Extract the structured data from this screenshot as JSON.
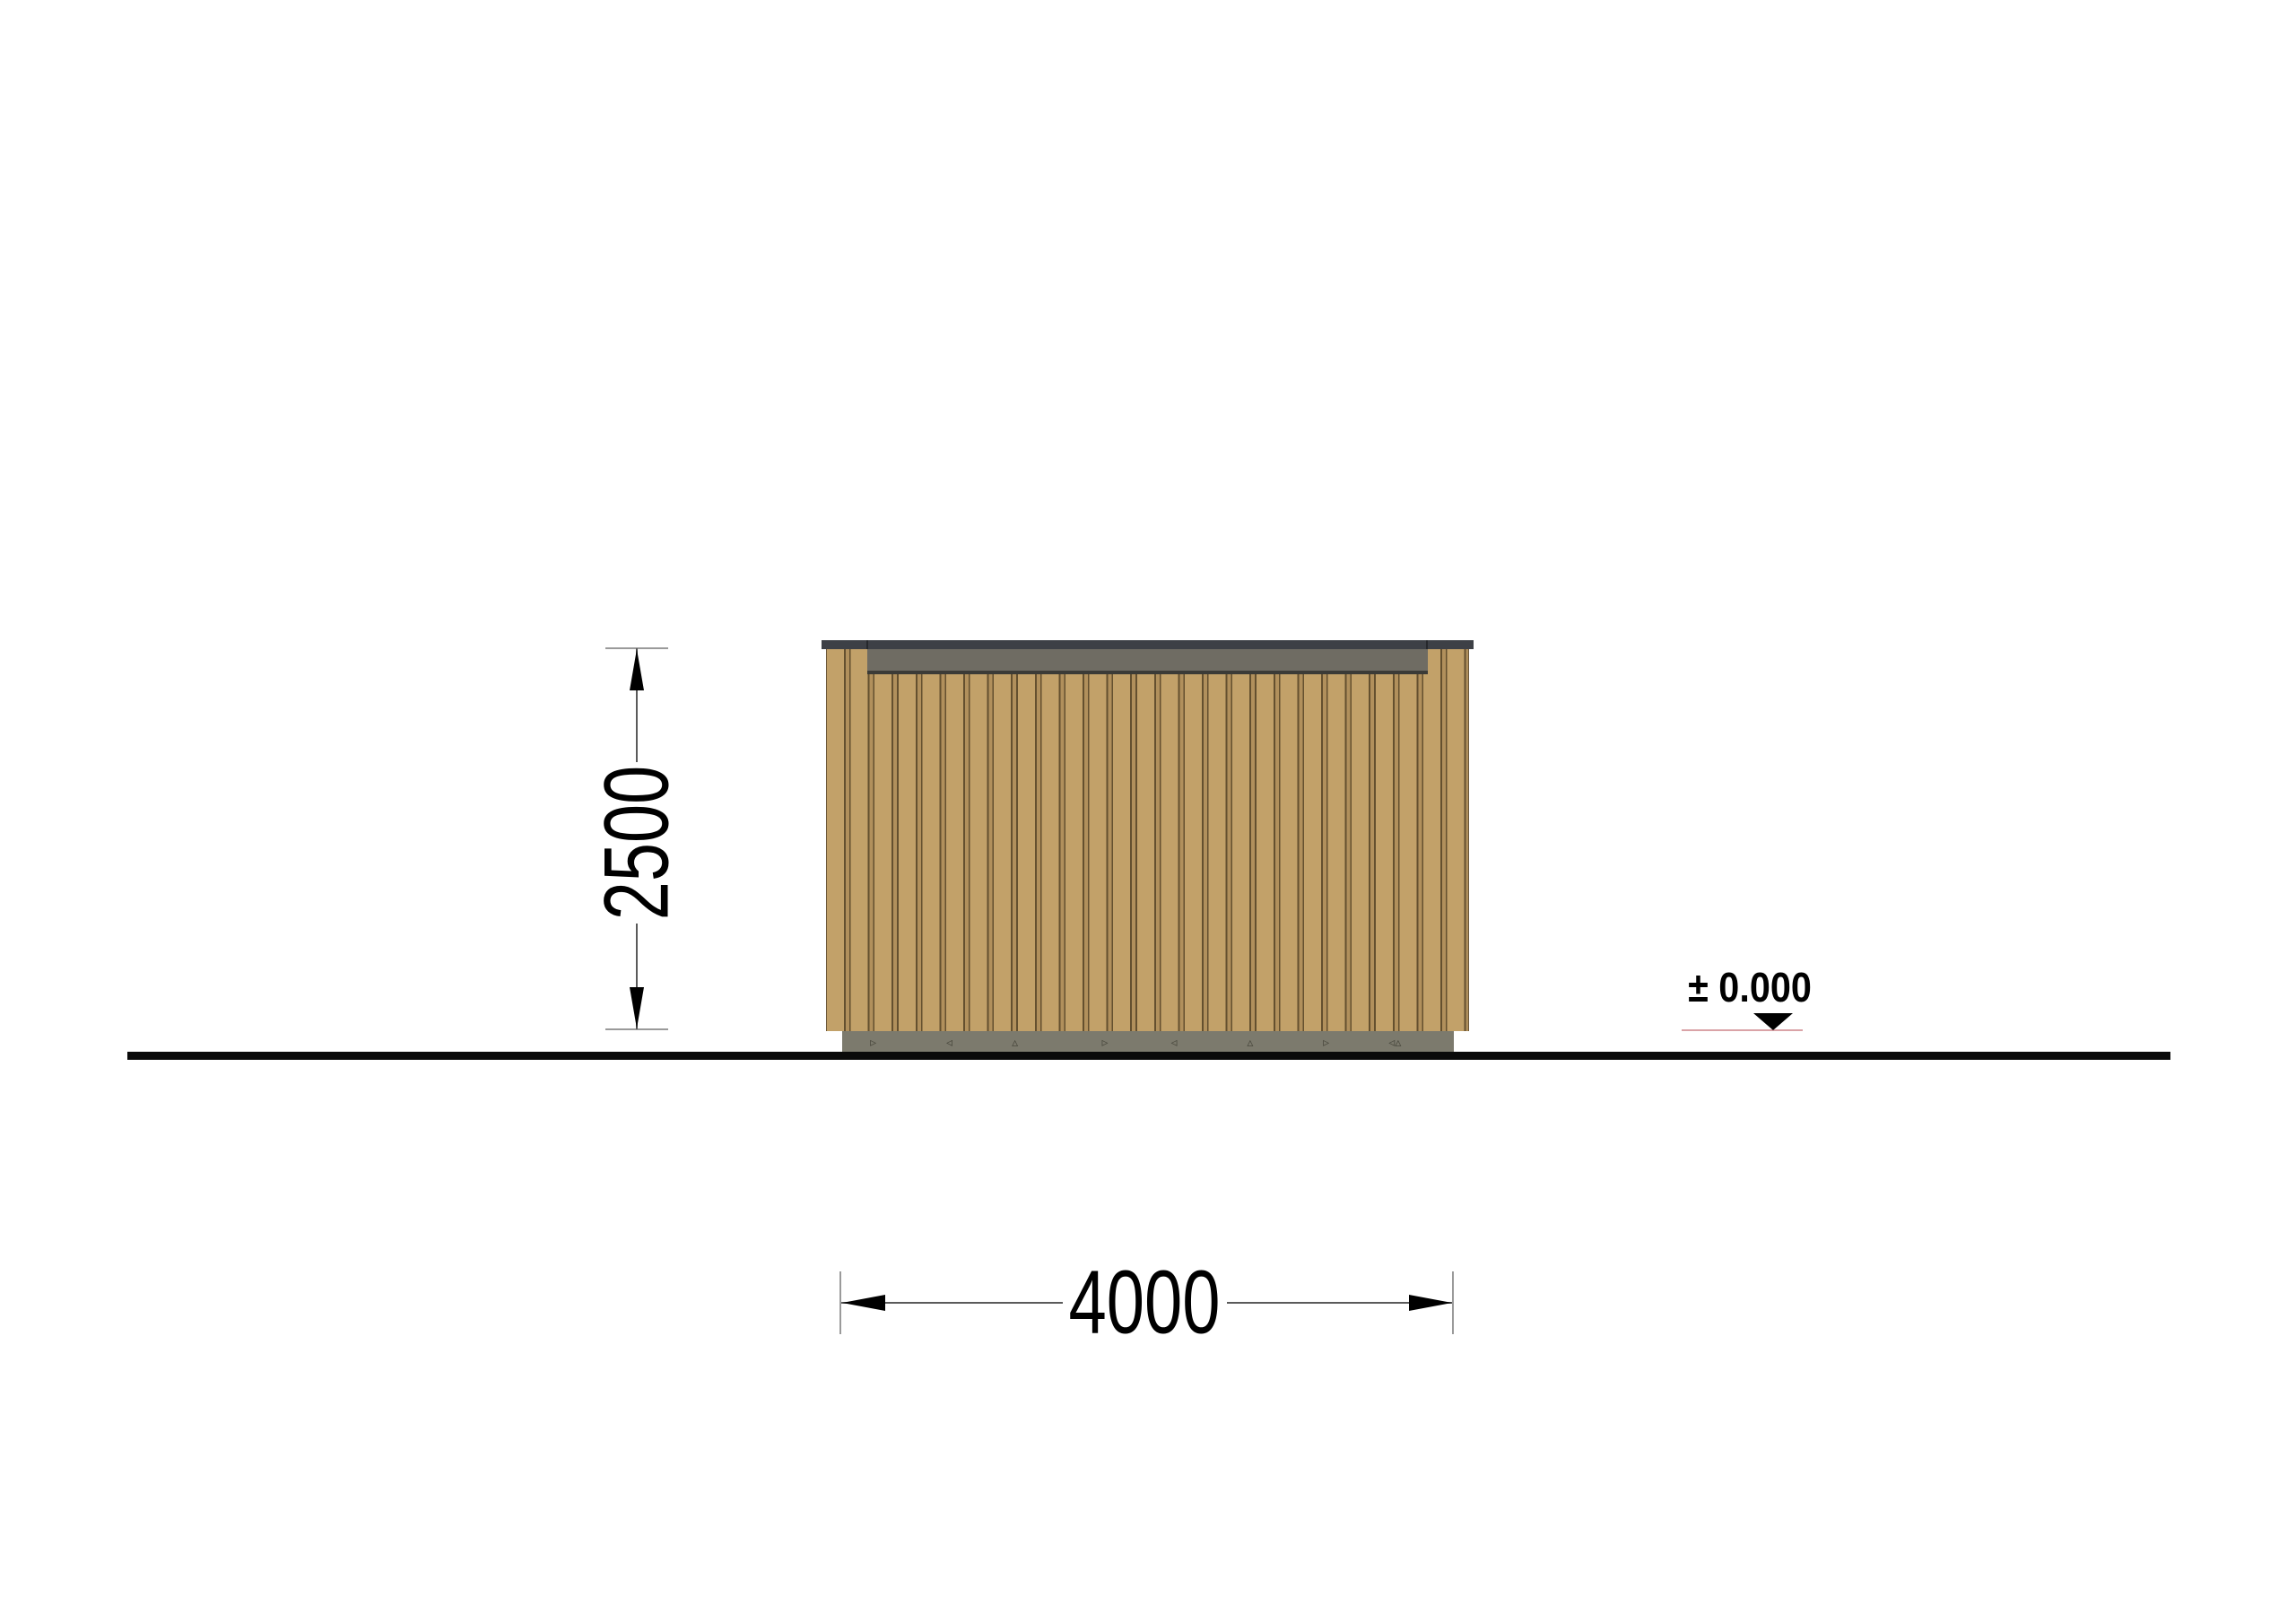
{
  "drawing": {
    "name": "cabin-side-elevation",
    "dimensions": {
      "height_mm": "2500",
      "width_mm": "4000",
      "ground_level": "± 0.000"
    },
    "foundation": {
      "speckle_texture": "        ▹                    ◃                 ▵                        ▹                  ◃                    ▵                    ▹                 ◃▵"
    },
    "colors": {
      "roof_slab": "#3d4046",
      "fascia": "#6f6c63",
      "fascia_edge": "#3b3b37",
      "wood_plank": "#c2a169",
      "wood_groove": "#64502f",
      "foundation_concrete": "#7c7a6d",
      "ground_line": "#0a0a0a",
      "dimension_text": "#000000",
      "level_underline": "#daa3a7"
    }
  }
}
